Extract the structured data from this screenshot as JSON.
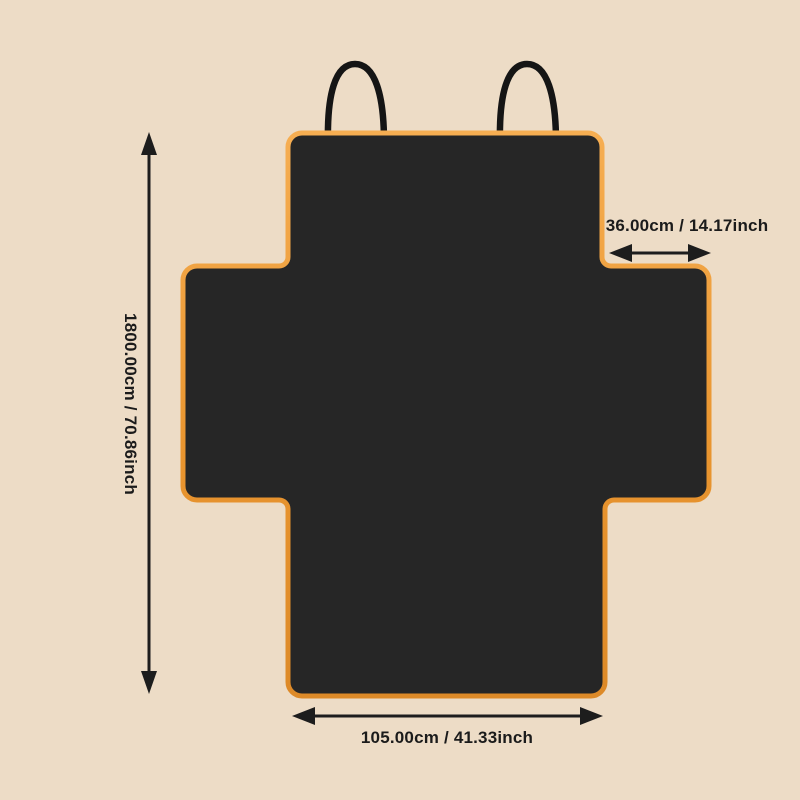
{
  "diagram": {
    "subject": "pet car seat cover size diagram",
    "dimensions": {
      "height": {
        "label": "1800.00cm / 70.86inch"
      },
      "top_flap_width": {
        "label": "36.00cm / 14.17inch"
      },
      "bottom_flap_width": {
        "label": "105.00cm / 41.33inch"
      }
    },
    "colors": {
      "background": "#eddcc6",
      "cover_fill": "#262626",
      "trim_orange": "#e9952f",
      "trim_highlight": "#f6ae52",
      "trim_shadow": "#dd8a28",
      "strap_black": "#151515",
      "annotation_black": "#1d1d1d"
    }
  }
}
